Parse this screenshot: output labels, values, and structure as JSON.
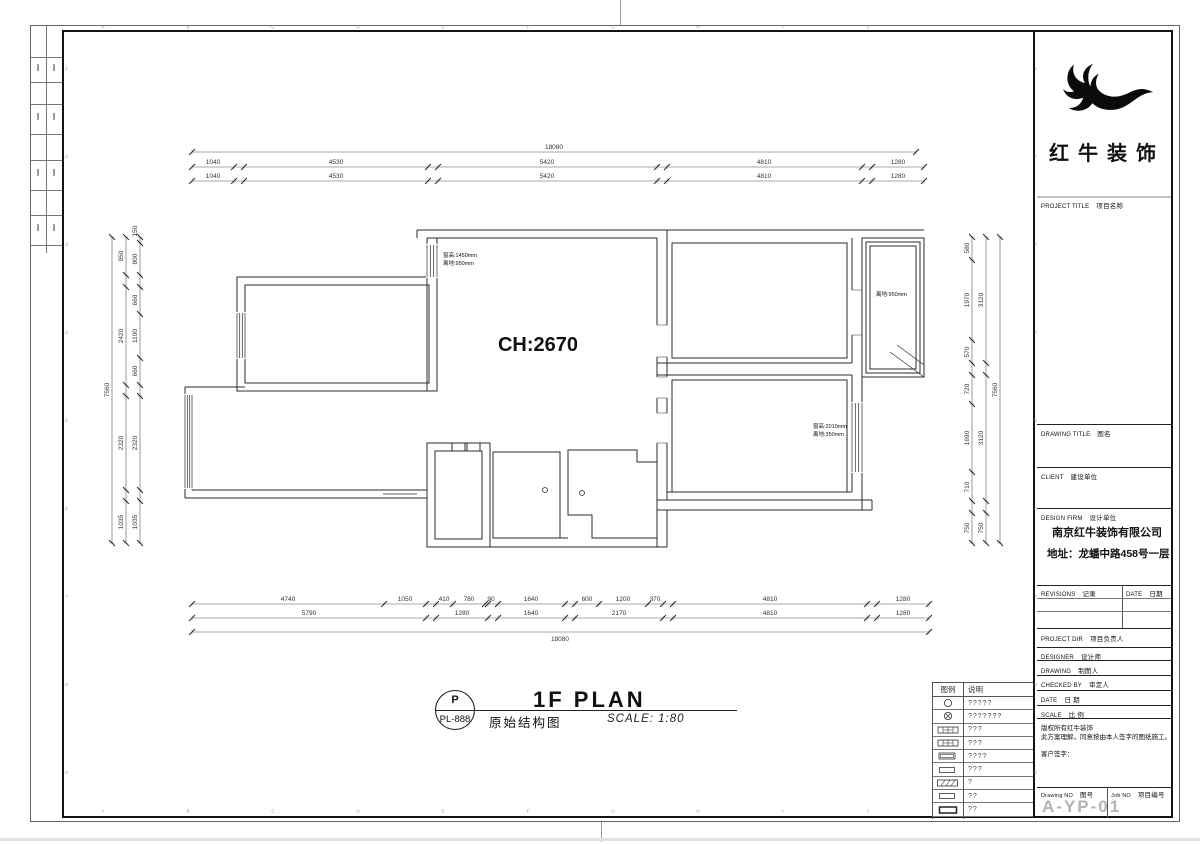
{
  "sheet": {
    "logo_text": "红牛装饰",
    "edge_letters": [
      "A",
      "B",
      "C",
      "D",
      "E",
      "F",
      "G",
      "H",
      "I",
      "J"
    ],
    "edge_numbers": [
      "1",
      "2",
      "3",
      "4",
      "5",
      "6",
      "7",
      "8",
      "9"
    ],
    "title_block": {
      "project_title_en": "PROJECT TITLE",
      "project_title_zh": "项目名称",
      "drawing_title_en": "DRAWING TITLE",
      "drawing_title_zh": "图名",
      "client_en": "CLIENT",
      "client_zh": "建设单位",
      "design_firm_en": "DESIGN FIRM",
      "design_firm_zh": "设计单位",
      "firm_name": "南京红牛装饰有限公司",
      "firm_address": "地址：龙蟠中路458号一层",
      "revisions_en": "REVISIONS",
      "revisions_zh": "记录",
      "date_col_en": "DATE",
      "date_col_zh": "日期",
      "project_dir_en": "PROJECT DIR",
      "project_dir_zh": "项目负责人",
      "designer_en": "DESIGNER",
      "designer_zh": "设计师",
      "drawing_en": "DRAWING",
      "drawing_zh": "制图人",
      "checked_en": "CHECKED BY",
      "checked_zh": "审定人",
      "date_en": "DATE",
      "date_zh": "日 期",
      "scale_en": "SCALE",
      "scale_zh": "比 例",
      "copyright_line1": "版权所有红牛装饰",
      "copyright_line2": "此方案理解，同意按由本人签字的图纸施工。",
      "copyright_line3": "客户签字：",
      "drawing_no_en": "Drawing NO",
      "drawing_no_zh": "图号",
      "job_no_en": "Job NO",
      "job_no_zh": "项目编号",
      "drawing_no": "A-YP-01"
    }
  },
  "plan": {
    "ch_label": "CH:2670",
    "ann_window1_l1": "窗高:1450mm",
    "ann_window1_l2": "离地:950mm",
    "ann_balcony": "离地:950mm",
    "ann_window2_l1": "窗高:2010mm",
    "ann_window2_l2": "离地:350mm",
    "dims": {
      "top_total": "18080",
      "top_row": [
        "1040",
        "4530",
        "5420",
        "4810",
        "1280"
      ],
      "bottom_row1": [
        "4740",
        "1050",
        "410",
        "780",
        "90",
        "1640",
        "600",
        "1200",
        "370",
        "4810",
        "1280"
      ],
      "bottom_row2": [
        "5790",
        "1280",
        "1640",
        "2170",
        "4810",
        "1280"
      ],
      "bottom_total": "18080",
      "left_total": "7560",
      "left_mid": [
        "950",
        "2420",
        "2320",
        "1035"
      ],
      "left_inner": [
        "150",
        "800",
        "660",
        "1100",
        "660",
        "2320",
        "1035"
      ],
      "right_total": "7560",
      "right_mid": [
        "3120",
        "3120",
        "750"
      ],
      "right_inner": [
        "580",
        "1970",
        "570",
        "720",
        "1690",
        "710",
        "750"
      ]
    }
  },
  "footer": {
    "stamp_top": "P",
    "stamp_code": "PL-888",
    "plan_title": "1F PLAN",
    "plan_subtitle": "原始结构图",
    "scale_text": "SCALE: 1:80"
  },
  "legend": {
    "header_symbol": "图例",
    "header_desc": "说明",
    "rows": [
      {
        "symbol": "circle",
        "desc": "?????"
      },
      {
        "symbol": "circle-cross",
        "desc": "???????"
      },
      {
        "symbol": "track-rect",
        "desc": "???"
      },
      {
        "symbol": "track-rect",
        "desc": "???"
      },
      {
        "symbol": "double-rect",
        "desc": "????"
      },
      {
        "symbol": "rect",
        "desc": "???"
      },
      {
        "symbol": "hatch-rect",
        "desc": "?"
      },
      {
        "symbol": "rect",
        "desc": "??"
      },
      {
        "symbol": "bold-rect",
        "desc": "??"
      },
      {
        "symbol": "dot",
        "desc": "????"
      }
    ]
  }
}
